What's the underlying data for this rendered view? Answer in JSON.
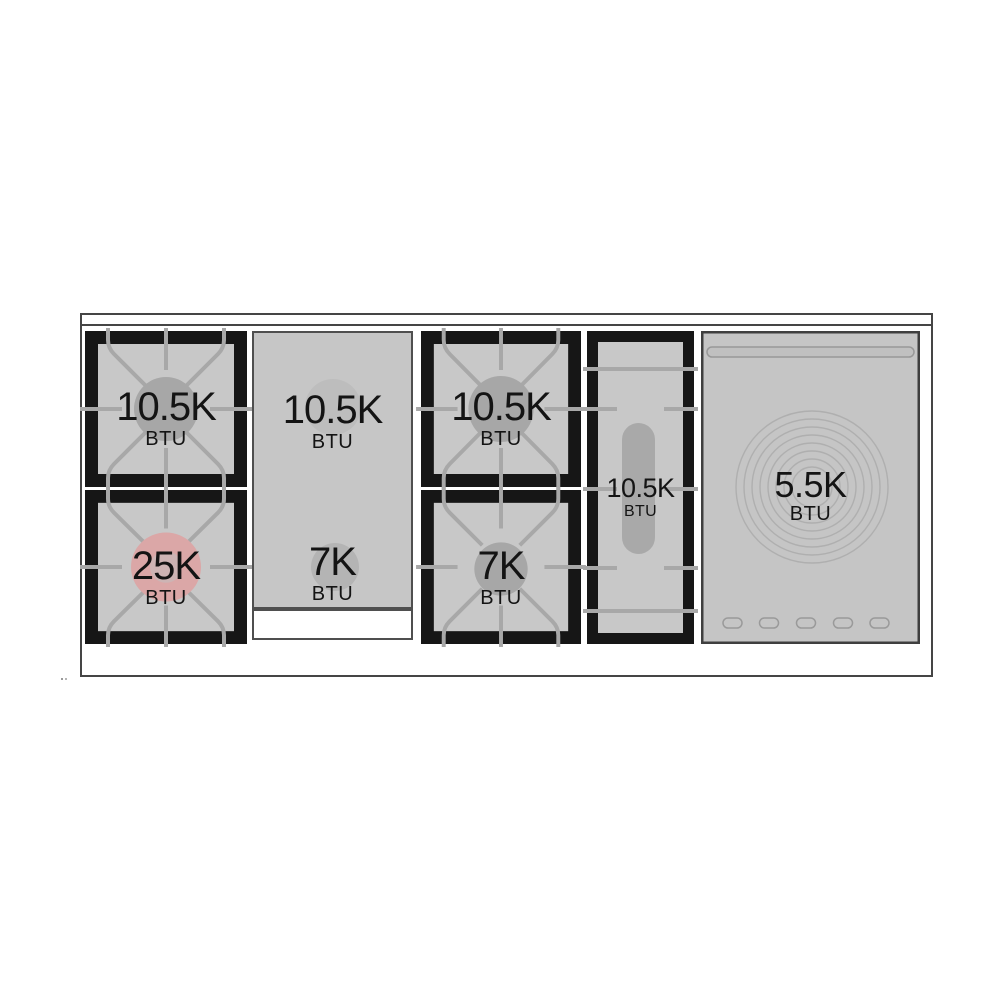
{
  "burners": {
    "left_top": {
      "value": "10.5K",
      "unit": "BTU"
    },
    "left_bottom": {
      "value": "25K",
      "unit": "BTU"
    },
    "griddle_top": {
      "value": "10.5K",
      "unit": "BTU"
    },
    "griddle_bottom": {
      "value": "7K",
      "unit": "BTU"
    },
    "center_top": {
      "value": "10.5K",
      "unit": "BTU"
    },
    "center_bottom": {
      "value": "7K",
      "unit": "BTU"
    },
    "oval": {
      "value": "10.5K",
      "unit": "BTU"
    },
    "french_plate": {
      "value": "5.5K",
      "unit": "BTU"
    }
  },
  "colors": {
    "background": "#ffffff",
    "surface_gray": "#c8c8c8",
    "griddle_gray": "#c6c6c6",
    "grate_black": "#161616",
    "grate_line_gray": "#a8a8a8",
    "outline_dark": "#454545",
    "burner_disc_gray": "#a7a7a7",
    "high_btu_disc_pink": "#dba7a7",
    "high_btu_disc_inner": "#cdb4b4",
    "oval_disc_gray": "#a9a9a9",
    "griddle_disc_light": "#bdbdbd",
    "griddle_disc_dark": "#b4b4b4",
    "ring_gray": "#afafaf",
    "text_black": "#141414"
  }
}
